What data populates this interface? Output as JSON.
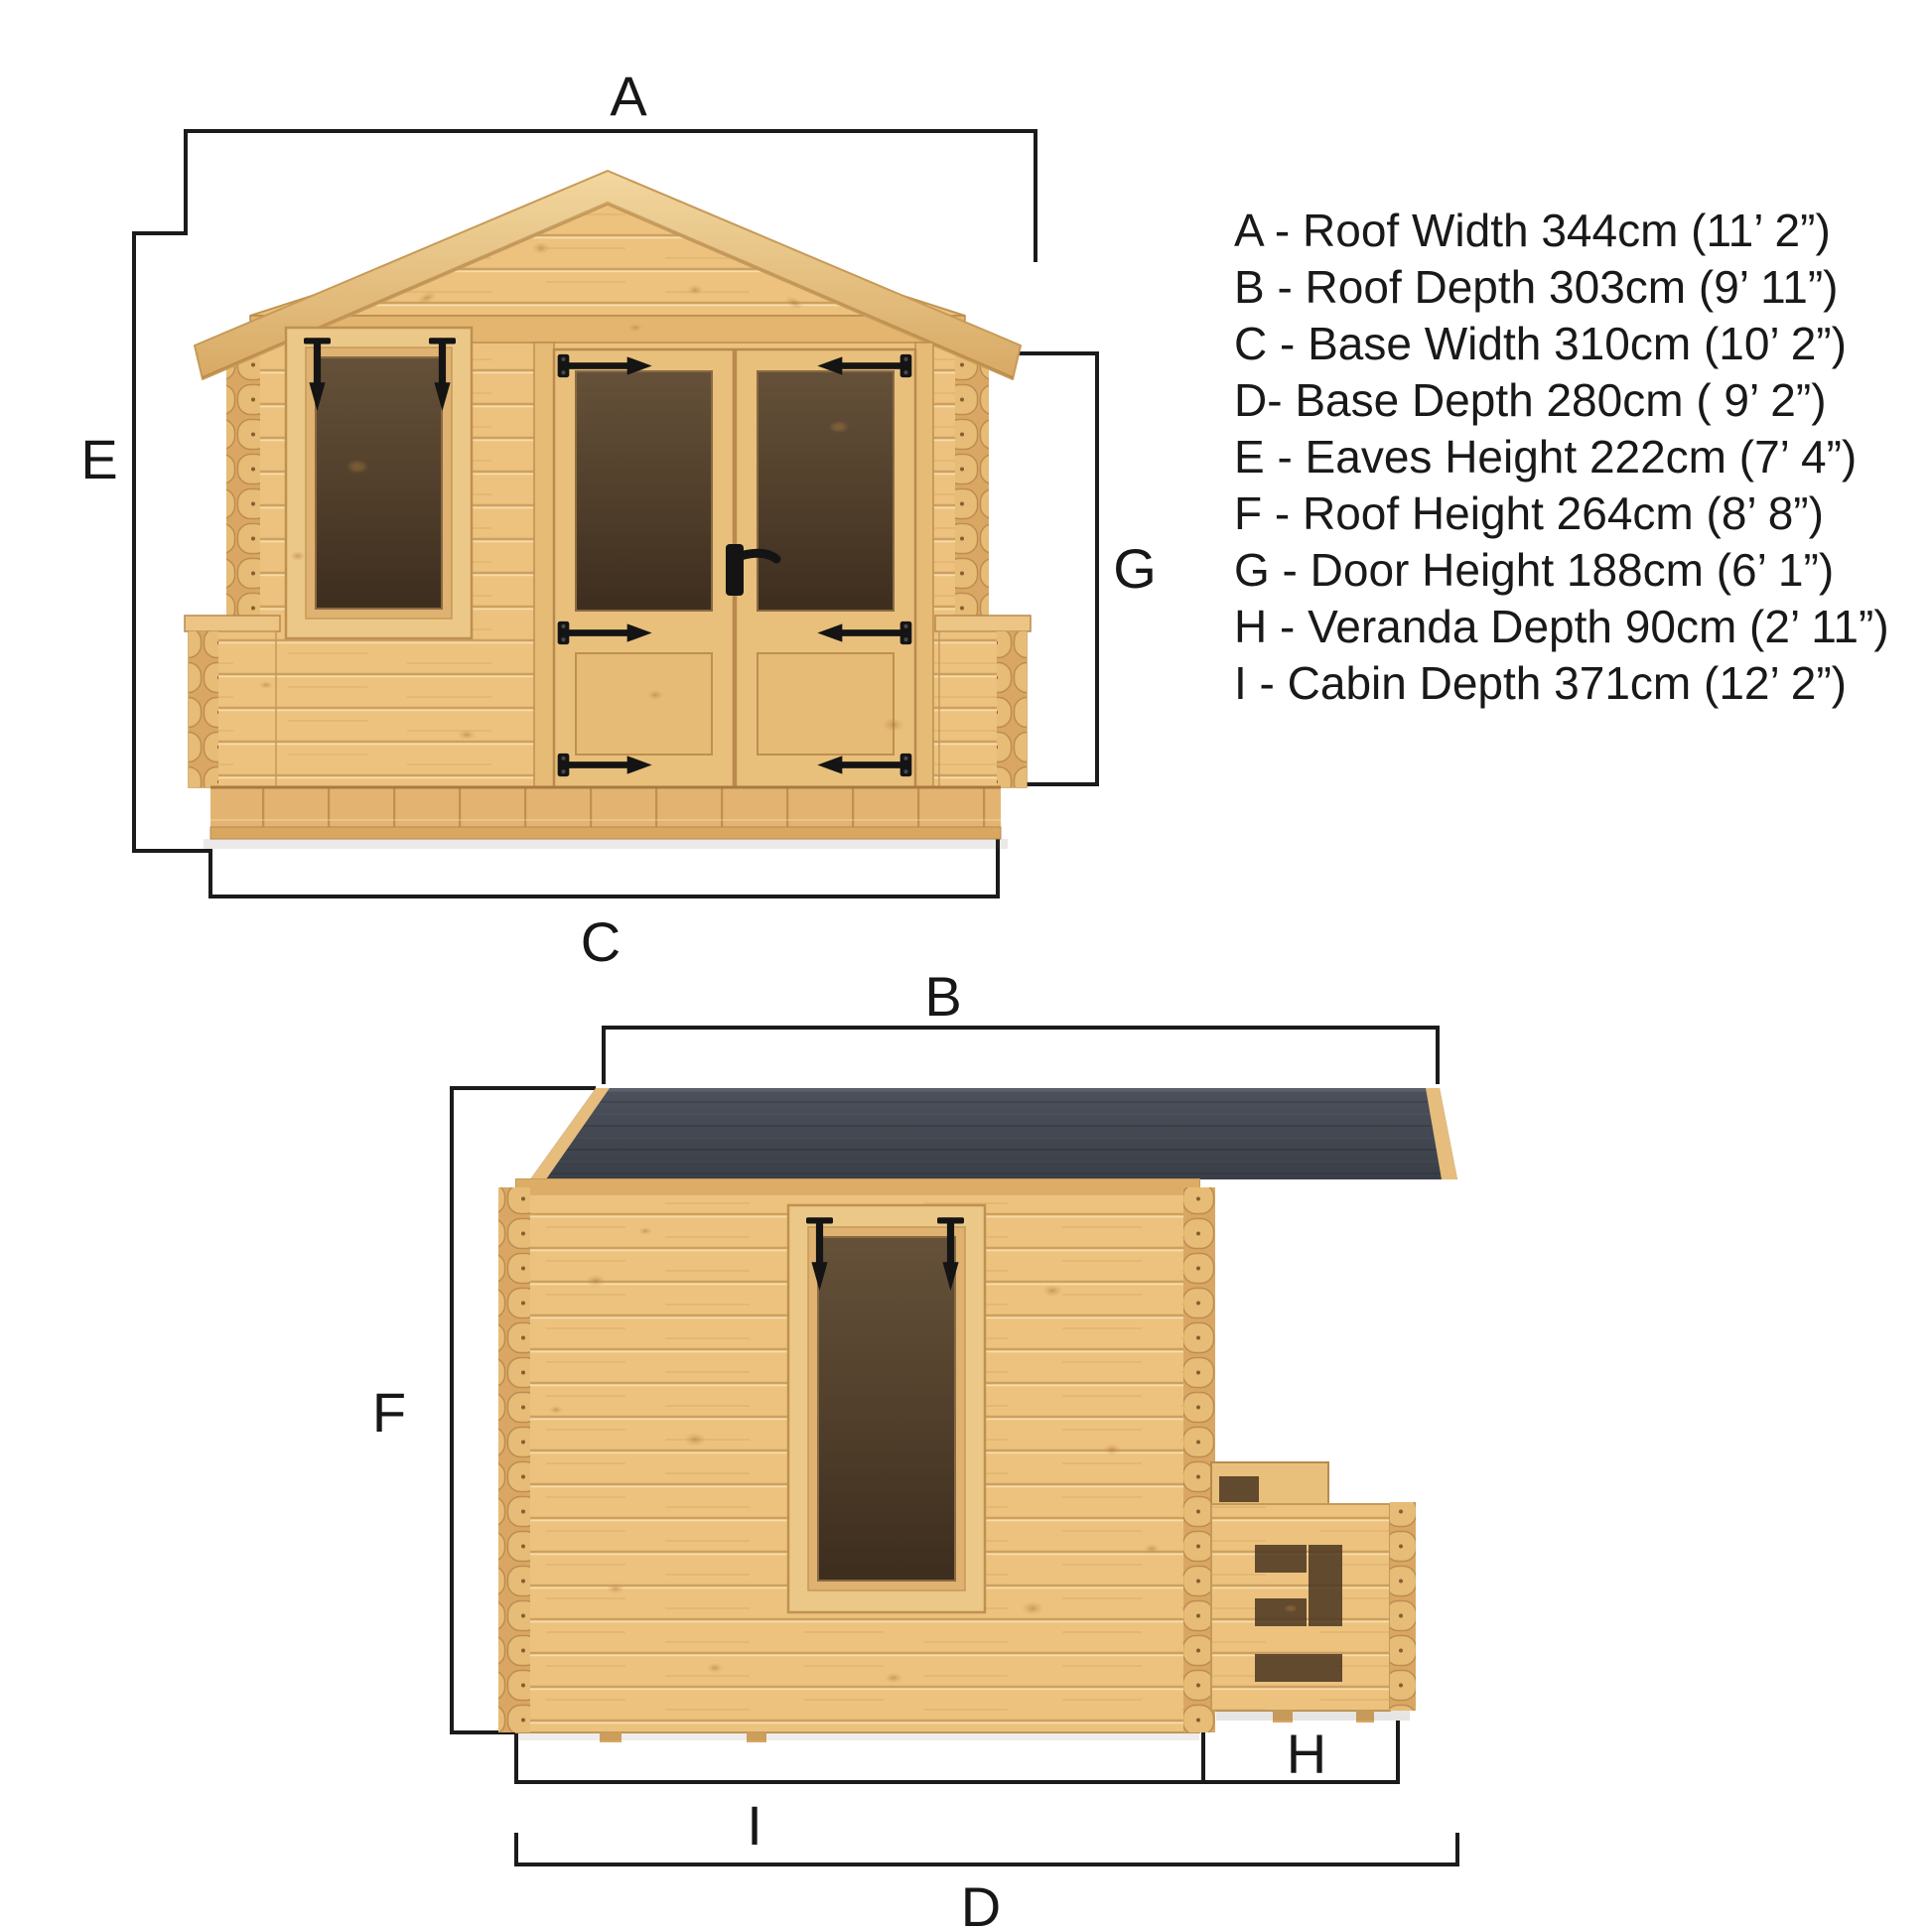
{
  "title": "Log cabin dimension diagram",
  "legend": {
    "items": [
      {
        "text": "A - Roof Width 344cm (11’ 2”)"
      },
      {
        "text": "B - Roof Depth 303cm (9’ 11”)"
      },
      {
        "text": "C - Base Width 310cm (10’ 2”)"
      },
      {
        "text": "D- Base Depth 280cm ( 9’ 2”)"
      },
      {
        "text": "E - Eaves Height 222cm (7’ 4”)"
      },
      {
        "text": "F - Roof Height 264cm (8’ 8”)"
      },
      {
        "text": "G - Door Height 188cm (6’ 1”)"
      },
      {
        "text": "H - Veranda Depth 90cm (2’ 11”)"
      },
      {
        "text": "I - Cabin Depth 371cm (12’ 2”)"
      }
    ]
  },
  "dims": {
    "a": "A",
    "b": "B",
    "c": "C",
    "d": "D",
    "e": "E",
    "f": "F",
    "g": "G",
    "h": "H",
    "i": "I"
  },
  "colors": {
    "background": "#ffffff",
    "wood_plank": "#ecc27e",
    "wood_light": "#f2d79f",
    "wood_mid": "#dfb071",
    "wood_dark": "#d9a763",
    "wood_trim": "#bf9150",
    "glass_top": "#655139",
    "glass_bottom": "#3d2d1e",
    "roof_felt_top": "#4c515b",
    "roof_felt_bottom": "#3a3e47",
    "hardware_black": "#141414",
    "dimension_line": "#1b1b1b",
    "text": "#191919"
  }
}
